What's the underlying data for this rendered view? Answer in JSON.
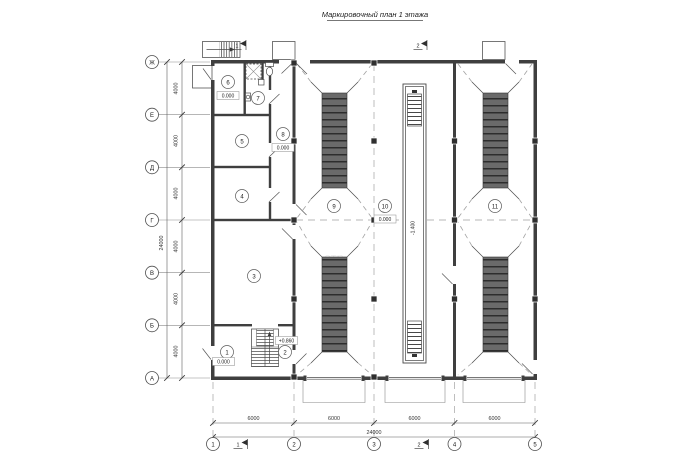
{
  "title": "Маркировочный план 1 этажа",
  "watermark": "стр",
  "axes": {
    "rows": [
      {
        "label": "Ж"
      },
      {
        "label": "Е"
      },
      {
        "label": "Д"
      },
      {
        "label": "Г"
      },
      {
        "label": "В"
      },
      {
        "label": "Б"
      },
      {
        "label": "А"
      }
    ],
    "cols": [
      {
        "label": "1"
      },
      {
        "label": "2"
      },
      {
        "label": "3"
      },
      {
        "label": "4"
      },
      {
        "label": "5"
      }
    ],
    "row_dims": [
      "4000",
      "4000",
      "4000",
      "4000",
      "4000",
      "4000"
    ],
    "row_total": "24000",
    "col_dims": [
      "6000",
      "6000",
      "6000",
      "6000"
    ],
    "col_total": "24000"
  },
  "sections": {
    "cut1": "1",
    "cut2": "2"
  },
  "rooms": [
    {
      "number": "1",
      "elevation": "0.000"
    },
    {
      "number": "2"
    },
    {
      "number": "3"
    },
    {
      "number": "4"
    },
    {
      "number": "5"
    },
    {
      "number": "6",
      "elevation": "0.000"
    },
    {
      "number": "7"
    },
    {
      "number": "8",
      "elevation": "0.000"
    },
    {
      "number": "9"
    },
    {
      "number": "10",
      "elevation": "0.000"
    },
    {
      "number": "11"
    }
  ],
  "annotations": {
    "stair_landing": "+0.860",
    "pit_depth": "-1.400"
  }
}
